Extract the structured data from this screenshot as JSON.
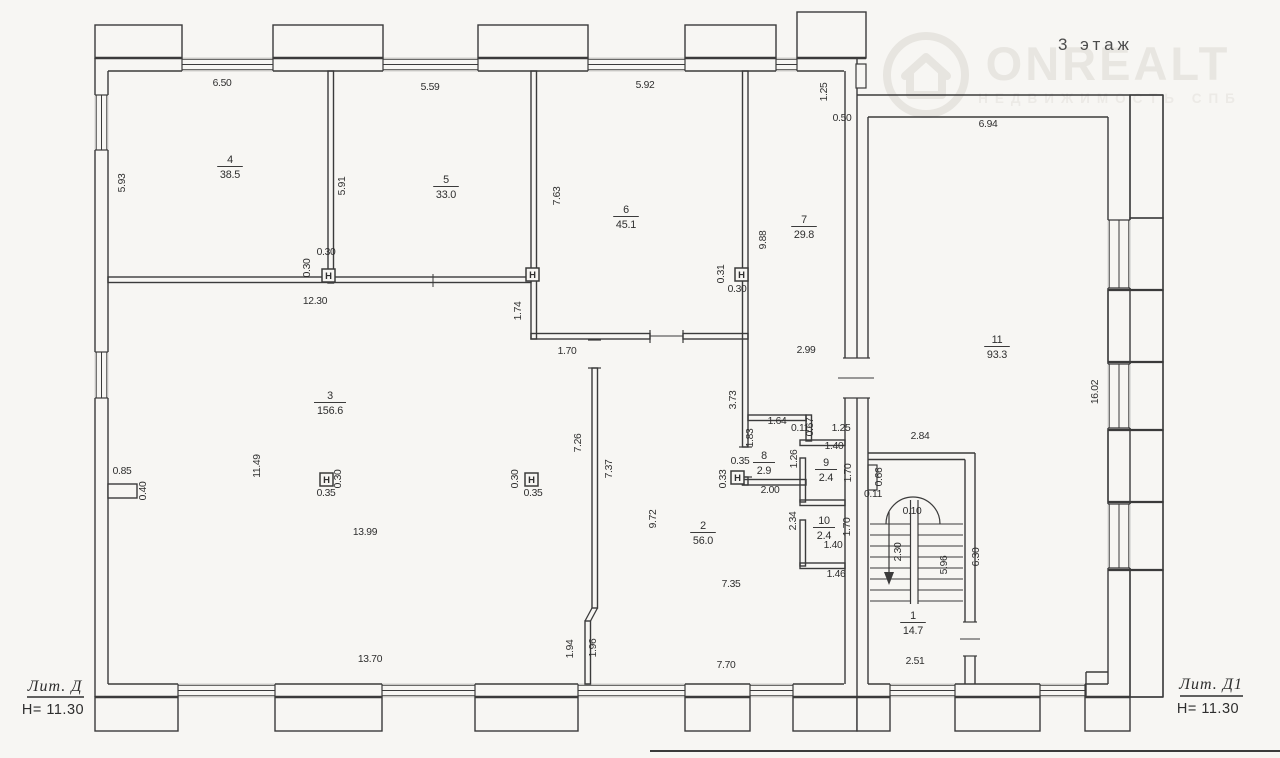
{
  "title": "3 этаж",
  "watermark": {
    "brand": "ONREALT",
    "tagline": "НЕДВИЖИМОСТЬ СПБ"
  },
  "legend_left": {
    "lit": "Лит. Д",
    "height": "Н= 11.30"
  },
  "legend_right": {
    "lit": "Лит. Д1",
    "height": "Н= 11.30"
  },
  "column_symbol": "H",
  "rooms": [
    {
      "number": "4",
      "area": "38.5",
      "x": 230,
      "y": 163
    },
    {
      "number": "5",
      "area": "33.0",
      "x": 446,
      "y": 183
    },
    {
      "number": "6",
      "area": "45.1",
      "x": 626,
      "y": 213
    },
    {
      "number": "7",
      "area": "29.8",
      "x": 804,
      "y": 223
    },
    {
      "number": "3",
      "area": "156.6",
      "x": 330,
      "y": 399
    },
    {
      "number": "2",
      "area": "56.0",
      "x": 703,
      "y": 529
    },
    {
      "number": "8",
      "area": "2.9",
      "x": 764,
      "y": 459
    },
    {
      "number": "9",
      "area": "2.4",
      "x": 826,
      "y": 466
    },
    {
      "number": "10",
      "area": "2.4",
      "x": 824,
      "y": 524
    },
    {
      "number": "1",
      "area": "14.7",
      "x": 913,
      "y": 619
    },
    {
      "number": "11",
      "area": "93.3",
      "x": 997,
      "y": 343
    }
  ],
  "dimensions": [
    {
      "t": "6.50",
      "x": 222,
      "y": 86
    },
    {
      "t": "5.59",
      "x": 430,
      "y": 90
    },
    {
      "t": "5.92",
      "x": 645,
      "y": 88
    },
    {
      "t": "1.25",
      "x": 827,
      "y": 92,
      "rot": true
    },
    {
      "t": "0.50",
      "x": 842,
      "y": 121
    },
    {
      "t": "6.94",
      "x": 988,
      "y": 127
    },
    {
      "t": "5.93",
      "x": 125,
      "y": 183,
      "rot": true
    },
    {
      "t": "5.91",
      "x": 345,
      "y": 186,
      "rot": true
    },
    {
      "t": "7.63",
      "x": 560,
      "y": 196,
      "rot": true
    },
    {
      "t": "9.88",
      "x": 766,
      "y": 240,
      "rot": true
    },
    {
      "t": "0.30",
      "x": 326,
      "y": 255
    },
    {
      "t": "0.30",
      "x": 310,
      "y": 268,
      "rot": true
    },
    {
      "t": "0.31",
      "x": 724,
      "y": 274,
      "rot": true
    },
    {
      "t": "0.30",
      "x": 737,
      "y": 292
    },
    {
      "t": "12.30",
      "x": 315,
      "y": 304
    },
    {
      "t": "1.74",
      "x": 521,
      "y": 311,
      "rot": true
    },
    {
      "t": "1.70",
      "x": 567,
      "y": 354
    },
    {
      "t": "2.99",
      "x": 806,
      "y": 353
    },
    {
      "t": "16.02",
      "x": 1098,
      "y": 392,
      "rot": true
    },
    {
      "t": "3.73",
      "x": 736,
      "y": 400,
      "rot": true
    },
    {
      "t": "11.49",
      "x": 260,
      "y": 466,
      "rot": true
    },
    {
      "t": "0.85",
      "x": 122,
      "y": 474
    },
    {
      "t": "0.40",
      "x": 146,
      "y": 491,
      "rot": true
    },
    {
      "t": "0.30",
      "x": 341,
      "y": 479,
      "rot": true
    },
    {
      "t": "0.35",
      "x": 326,
      "y": 496
    },
    {
      "t": "0.30",
      "x": 518,
      "y": 479,
      "rot": true
    },
    {
      "t": "0.35",
      "x": 533,
      "y": 496
    },
    {
      "t": "13.99",
      "x": 365,
      "y": 535
    },
    {
      "t": "7.26",
      "x": 581,
      "y": 443,
      "rot": true
    },
    {
      "t": "7.37",
      "x": 612,
      "y": 469,
      "rot": true
    },
    {
      "t": "9.72",
      "x": 656,
      "y": 519,
      "rot": true
    },
    {
      "t": "7.35",
      "x": 731,
      "y": 587
    },
    {
      "t": "1.64",
      "x": 777,
      "y": 424
    },
    {
      "t": "0.11",
      "x": 800,
      "y": 431
    },
    {
      "t": "0.67",
      "x": 813,
      "y": 427,
      "rot": true
    },
    {
      "t": "1.25",
      "x": 841,
      "y": 431
    },
    {
      "t": "1.83",
      "x": 753,
      "y": 438,
      "rot": true
    },
    {
      "t": "1.26",
      "x": 797,
      "y": 459,
      "rot": true
    },
    {
      "t": "1.40",
      "x": 834,
      "y": 449
    },
    {
      "t": "1.70",
      "x": 851,
      "y": 473,
      "rot": true
    },
    {
      "t": "0.35",
      "x": 740,
      "y": 464
    },
    {
      "t": "0.33",
      "x": 726,
      "y": 479,
      "rot": true
    },
    {
      "t": "2.00",
      "x": 770,
      "y": 493
    },
    {
      "t": "2.34",
      "x": 796,
      "y": 521,
      "rot": true
    },
    {
      "t": "1.70",
      "x": 850,
      "y": 527,
      "rot": true
    },
    {
      "t": "1.40",
      "x": 833,
      "y": 548
    },
    {
      "t": "1.46",
      "x": 836,
      "y": 577
    },
    {
      "t": "2.84",
      "x": 920,
      "y": 439
    },
    {
      "t": "0.66",
      "x": 882,
      "y": 477,
      "rot": true
    },
    {
      "t": "0.11",
      "x": 873,
      "y": 497
    },
    {
      "t": "0.10",
      "x": 912,
      "y": 514
    },
    {
      "t": "2.30",
      "x": 901,
      "y": 552,
      "rot": true
    },
    {
      "t": "5.96",
      "x": 947,
      "y": 565,
      "rot": true
    },
    {
      "t": "6.30",
      "x": 979,
      "y": 557,
      "rot": true
    },
    {
      "t": "2.51",
      "x": 915,
      "y": 664
    },
    {
      "t": "13.70",
      "x": 370,
      "y": 662
    },
    {
      "t": "1.94",
      "x": 573,
      "y": 649,
      "rot": true
    },
    {
      "t": "1.96",
      "x": 596,
      "y": 648,
      "rot": true
    },
    {
      "t": "7.70",
      "x": 726,
      "y": 668
    }
  ],
  "columns": [
    {
      "x": 322,
      "y": 269
    },
    {
      "x": 526,
      "y": 268
    },
    {
      "x": 735,
      "y": 268
    },
    {
      "x": 320,
      "y": 473
    },
    {
      "x": 525,
      "y": 473
    },
    {
      "x": 731,
      "y": 471
    }
  ]
}
